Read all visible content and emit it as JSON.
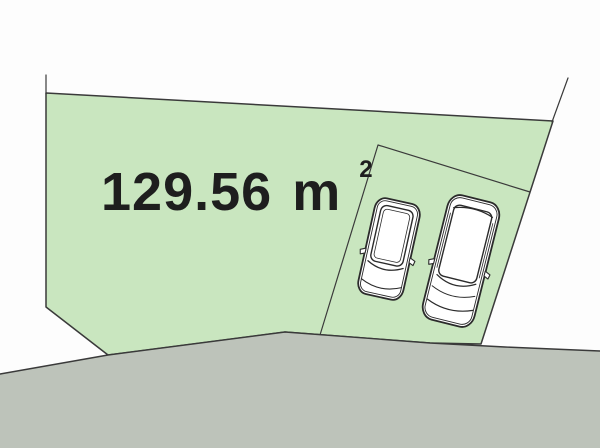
{
  "diagram": {
    "area_value": "129.56",
    "area_unit": "m",
    "area_exponent": "2"
  },
  "colors": {
    "background": "#fdfdfd",
    "plot_fill": "#c9e6bf",
    "road_fill": "#bdc3ba",
    "line": "#3a3a3a",
    "car_fill": "#ffffff",
    "car_line": "#2b2b2b",
    "text": "#1e1e1e"
  }
}
